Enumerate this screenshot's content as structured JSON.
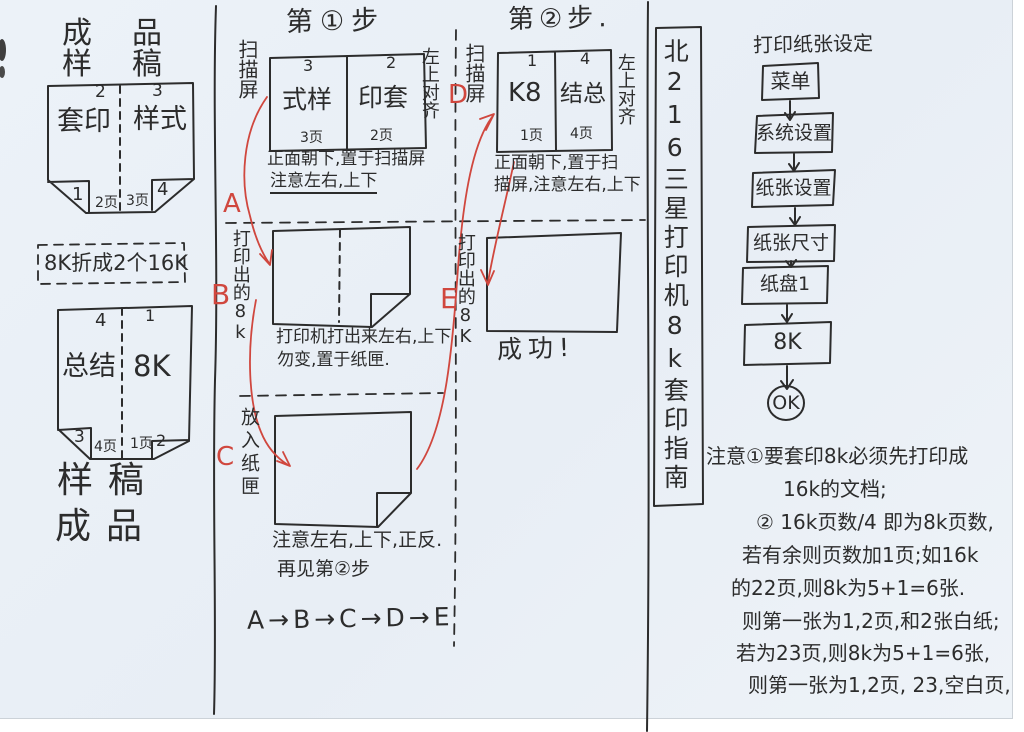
{
  "colors": {
    "paper": "#ebf1f7",
    "ink": "#2c2c2c",
    "red": "#d0473e"
  },
  "left_panel": {
    "top_label_row1": "成品",
    "top_label_row2": "样稿",
    "box1": {
      "num_top_left": "2",
      "num_top_right": "3",
      "cell_left": "套印",
      "cell_right": "样式",
      "flap_left": "1",
      "flap_right": "4",
      "page_left": "2页",
      "page_right": "3页"
    },
    "fold_note": "8K折成2个16K",
    "box2": {
      "num_top_left": "4",
      "num_top_right": "1",
      "cell_left": "总结",
      "cell_right": "8K",
      "flap_left": "3",
      "flap_right": "2",
      "page_left": "4页",
      "page_right": "1页"
    },
    "bottom_label_row1": "样稿",
    "bottom_label_row2": "成品"
  },
  "step1": {
    "title": "第①步",
    "scanner_label": "扫描屏",
    "align_label": "左上对齐",
    "box": {
      "num_left": "3",
      "num_right": "2",
      "cell_left": "式样",
      "cell_right": "印套",
      "page_left": "3页",
      "page_right": "2页"
    },
    "caption_line1": "正面朝下,置于扫描屏",
    "caption_line2": "注意左右,上下",
    "marker_a": "A",
    "printed_label": "打印出的8k",
    "marker_b": "B",
    "printer_note_line1": "打印机打出来左右,上下",
    "printer_note_line2": "勿变,置于纸匣.",
    "marker_c": "C",
    "tray_label": "放入纸匣",
    "tray_note_line1": "注意左右,上下,正反.",
    "tray_note_line2": "再见第②步",
    "sequence": "A→B→C→D→E"
  },
  "step2": {
    "title": "第②步.",
    "marker_d": "D",
    "scanner_label": "扫描屏",
    "align_label": "左上对齐",
    "box": {
      "num_left": "1",
      "num_right": "4",
      "cell_left": "K8",
      "cell_right": "结总",
      "page_left": "1页",
      "page_right": "4页"
    },
    "caption_line1": "正面朝下,置于扫",
    "caption_line2": "描屏,注意左右,上下",
    "marker_e": "E",
    "printed_label": "打印出的8K",
    "success": "成功!"
  },
  "title_strip": "北216三星打印机8k套印指南",
  "flowchart": {
    "title": "打印纸张设定",
    "steps": [
      "菜单",
      "系统设置",
      "纸张设置",
      "纸张尺寸",
      "纸盘1",
      "8K"
    ],
    "end": "OK"
  },
  "notes": {
    "line1": "注意①要套印8k必须先打印成",
    "line2": "16k的文档;",
    "line3": "② 16k页数/4 即为8k页数,",
    "line4": "若有余则页数加1页;如16k",
    "line5": "的22页,则8k为5+1=6张.",
    "line6": "则第一张为1,2页,和2张白纸;",
    "line7": "若为23页,则8k为5+1=6张,",
    "line8": "则第一张为1,2页, 23,空白页,"
  }
}
